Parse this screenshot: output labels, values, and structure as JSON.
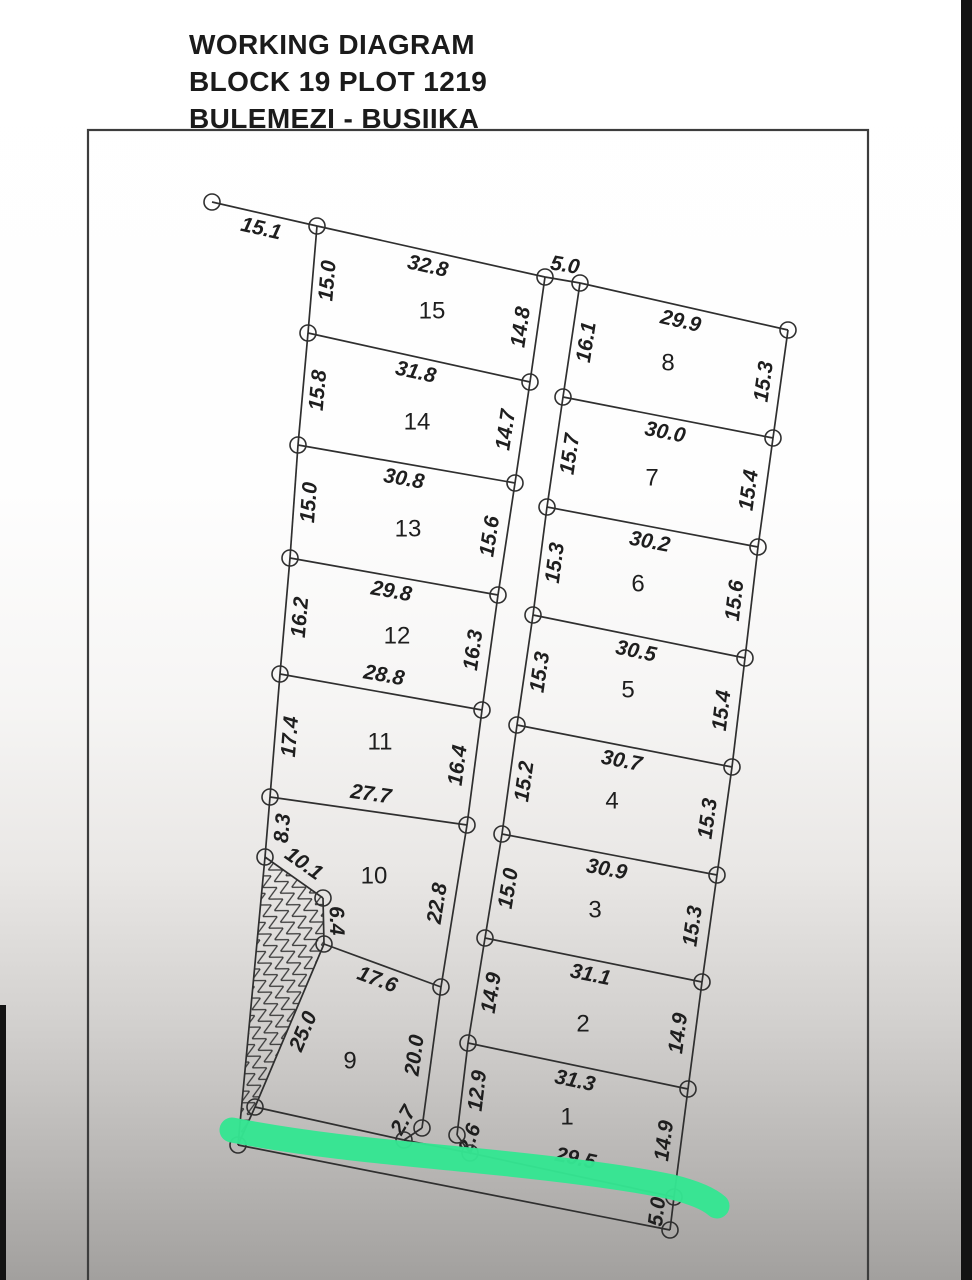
{
  "title": {
    "line1": "WORKING DIAGRAM",
    "line2": "BLOCK 19 PLOT 1219",
    "line3": "BULEMEZI - BUSIIKA"
  },
  "colors": {
    "line": "#2f2f2f",
    "border": "#3d3d3d",
    "label": "#1e1e1e",
    "highlighter": "#35e592"
  },
  "diagram": {
    "border": {
      "x": 88,
      "y": 130,
      "w": 780,
      "h": 1170
    },
    "nodes": {
      "A1": [
        212,
        202
      ],
      "A2": [
        317,
        226
      ],
      "A3": [
        308,
        333
      ],
      "A4": [
        298,
        445
      ],
      "A5": [
        290,
        558
      ],
      "A6": [
        280,
        674
      ],
      "A7": [
        270,
        797
      ],
      "A8": [
        265,
        857
      ],
      "A9": [
        323,
        898
      ],
      "A10": [
        324,
        944
      ],
      "A11": [
        255,
        1107
      ],
      "A12": [
        238,
        1145
      ],
      "B1": [
        545,
        277
      ],
      "B2": [
        530,
        382
      ],
      "B3": [
        515,
        483
      ],
      "B4": [
        498,
        595
      ],
      "B5": [
        482,
        710
      ],
      "B6": [
        467,
        825
      ],
      "B7": [
        441,
        987
      ],
      "B8": [
        422,
        1128
      ],
      "B9": [
        404,
        1140
      ],
      "C1": [
        580,
        283
      ],
      "C2": [
        563,
        397
      ],
      "C3": [
        547,
        507
      ],
      "C4": [
        533,
        615
      ],
      "C5": [
        517,
        725
      ],
      "C6": [
        502,
        834
      ],
      "C7": [
        485,
        938
      ],
      "C8": [
        468,
        1043
      ],
      "C9": [
        457,
        1135
      ],
      "C10": [
        470,
        1153
      ],
      "D1": [
        788,
        330
      ],
      "D2": [
        773,
        438
      ],
      "D3": [
        758,
        547
      ],
      "D4": [
        745,
        658
      ],
      "D5": [
        732,
        767
      ],
      "D6": [
        717,
        875
      ],
      "D7": [
        702,
        982
      ],
      "D8": [
        688,
        1089
      ],
      "D9": [
        674,
        1197
      ],
      "D10": [
        670,
        1230
      ]
    },
    "edges": [
      {
        "a": "A1",
        "b": "A2",
        "label": "15.1",
        "side": -1
      },
      {
        "a": "A2",
        "b": "A3",
        "label": "15.0",
        "side": 1
      },
      {
        "a": "A3",
        "b": "A4",
        "label": "15.8",
        "side": 1
      },
      {
        "a": "A4",
        "b": "A5",
        "label": "15.0",
        "side": 1
      },
      {
        "a": "A5",
        "b": "A6",
        "label": "16.2",
        "side": 1
      },
      {
        "a": "A6",
        "b": "A7",
        "label": "17.4",
        "side": 1
      },
      {
        "a": "A7",
        "b": "A8",
        "label": "8.3",
        "side": 1
      },
      {
        "a": "A8",
        "b": "A9",
        "label": "10.1",
        "side": 1
      },
      {
        "a": "A9",
        "b": "A10",
        "label": "6.4",
        "side": 1,
        "offset": 12
      },
      {
        "a": "A10",
        "b": "A11",
        "label": "25.0",
        "side": 1
      },
      {
        "a": "A11",
        "b": "A12"
      },
      {
        "a": "A8",
        "b": "A12"
      },
      {
        "a": "A12",
        "b": "D10"
      },
      {
        "a": "A11",
        "b": "B9"
      },
      {
        "a": "B9",
        "b": "C10"
      },
      {
        "a": "C10",
        "b": "D9",
        "label": "29.5",
        "side": 1
      },
      {
        "a": "B1",
        "b": "B2",
        "label": "14.8",
        "side": -1
      },
      {
        "a": "B2",
        "b": "B3",
        "label": "14.7",
        "side": -1
      },
      {
        "a": "B3",
        "b": "B4",
        "label": "15.6",
        "side": -1
      },
      {
        "a": "B4",
        "b": "B5",
        "label": "16.3",
        "side": -1
      },
      {
        "a": "B5",
        "b": "B6",
        "label": "16.4",
        "side": -1
      },
      {
        "a": "B6",
        "b": "B7",
        "label": "22.8",
        "side": -1
      },
      {
        "a": "B7",
        "b": "B8",
        "label": "20.0",
        "side": -1
      },
      {
        "a": "B8",
        "b": "B9",
        "label": "2.7",
        "side": -1,
        "rot": -60
      },
      {
        "a": "C1",
        "b": "C2",
        "label": "16.1",
        "side": 1
      },
      {
        "a": "C2",
        "b": "C3",
        "label": "15.7",
        "side": 1
      },
      {
        "a": "C3",
        "b": "C4",
        "label": "15.3",
        "side": 1
      },
      {
        "a": "C4",
        "b": "C5",
        "label": "15.3",
        "side": 1
      },
      {
        "a": "C5",
        "b": "C6",
        "label": "15.2",
        "side": 1
      },
      {
        "a": "C6",
        "b": "C7",
        "label": "15.0",
        "side": 1
      },
      {
        "a": "C7",
        "b": "C8",
        "label": "14.9",
        "side": 1
      },
      {
        "a": "C8",
        "b": "C9",
        "label": "12.9",
        "side": 1
      },
      {
        "a": "C9",
        "b": "C10",
        "label": "2.6",
        "side": 1,
        "offset": 9,
        "rot": -70
      },
      {
        "a": "D1",
        "b": "D2",
        "label": "15.3",
        "side": -1
      },
      {
        "a": "D2",
        "b": "D3",
        "label": "15.4",
        "side": -1
      },
      {
        "a": "D3",
        "b": "D4",
        "label": "15.6",
        "side": -1
      },
      {
        "a": "D4",
        "b": "D5",
        "label": "15.4",
        "side": -1
      },
      {
        "a": "D5",
        "b": "D6",
        "label": "15.3",
        "side": -1
      },
      {
        "a": "D6",
        "b": "D7",
        "label": "15.3",
        "side": -1
      },
      {
        "a": "D7",
        "b": "D8",
        "label": "14.9",
        "side": -1
      },
      {
        "a": "D8",
        "b": "D9",
        "label": "14.9",
        "side": -1
      },
      {
        "a": "D9",
        "b": "D10",
        "label": "5.0",
        "side": -1,
        "offset": 14
      },
      {
        "a": "A2",
        "b": "B1",
        "label": "32.8",
        "side": -1
      },
      {
        "a": "A3",
        "b": "B2",
        "label": "31.8",
        "side": -1
      },
      {
        "a": "A4",
        "b": "B3",
        "label": "30.8",
        "side": -1
      },
      {
        "a": "A5",
        "b": "B4",
        "label": "29.8",
        "side": -1
      },
      {
        "a": "A6",
        "b": "B5",
        "label": "28.8",
        "side": 1
      },
      {
        "a": "A7",
        "b": "B6",
        "label": "27.7",
        "side": 1
      },
      {
        "a": "A10",
        "b": "B7",
        "label": "17.6",
        "side": -1
      },
      {
        "a": "B1",
        "b": "C1",
        "label": "5.0",
        "side": 1,
        "offset": 14
      },
      {
        "a": "C1",
        "b": "D1",
        "label": "29.9",
        "side": -1
      },
      {
        "a": "C2",
        "b": "D2",
        "label": "30.0",
        "side": -1
      },
      {
        "a": "C3",
        "b": "D3",
        "label": "30.2",
        "side": -1
      },
      {
        "a": "C4",
        "b": "D4",
        "label": "30.5",
        "side": -1
      },
      {
        "a": "C5",
        "b": "D5",
        "label": "30.7",
        "side": -1
      },
      {
        "a": "C6",
        "b": "D6",
        "label": "30.9",
        "side": -1
      },
      {
        "a": "C7",
        "b": "D7",
        "label": "31.1",
        "side": -1
      },
      {
        "a": "C8",
        "b": "D8",
        "label": "31.3",
        "side": -1
      }
    ],
    "plots": [
      {
        "n": "15",
        "x": 432,
        "y": 312
      },
      {
        "n": "14",
        "x": 417,
        "y": 423
      },
      {
        "n": "13",
        "x": 408,
        "y": 530
      },
      {
        "n": "12",
        "x": 397,
        "y": 637
      },
      {
        "n": "11",
        "x": 380,
        "y": 743
      },
      {
        "n": "10",
        "x": 374,
        "y": 877
      },
      {
        "n": "9",
        "x": 350,
        "y": 1062
      },
      {
        "n": "8",
        "x": 668,
        "y": 364
      },
      {
        "n": "7",
        "x": 652,
        "y": 479
      },
      {
        "n": "6",
        "x": 638,
        "y": 585
      },
      {
        "n": "5",
        "x": 628,
        "y": 691
      },
      {
        "n": "4",
        "x": 612,
        "y": 802
      },
      {
        "n": "3",
        "x": 595,
        "y": 911
      },
      {
        "n": "2",
        "x": 583,
        "y": 1025
      },
      {
        "n": "1",
        "x": 567,
        "y": 1118
      }
    ],
    "hatch_polygon": [
      "A8",
      "A9",
      "A10",
      "A11",
      "A12"
    ],
    "highlighter_path": "M 232 1130 C 320 1147 400 1153 480 1161 C 560 1169 630 1178 672 1187 C 692 1192 708 1198 717 1206"
  }
}
